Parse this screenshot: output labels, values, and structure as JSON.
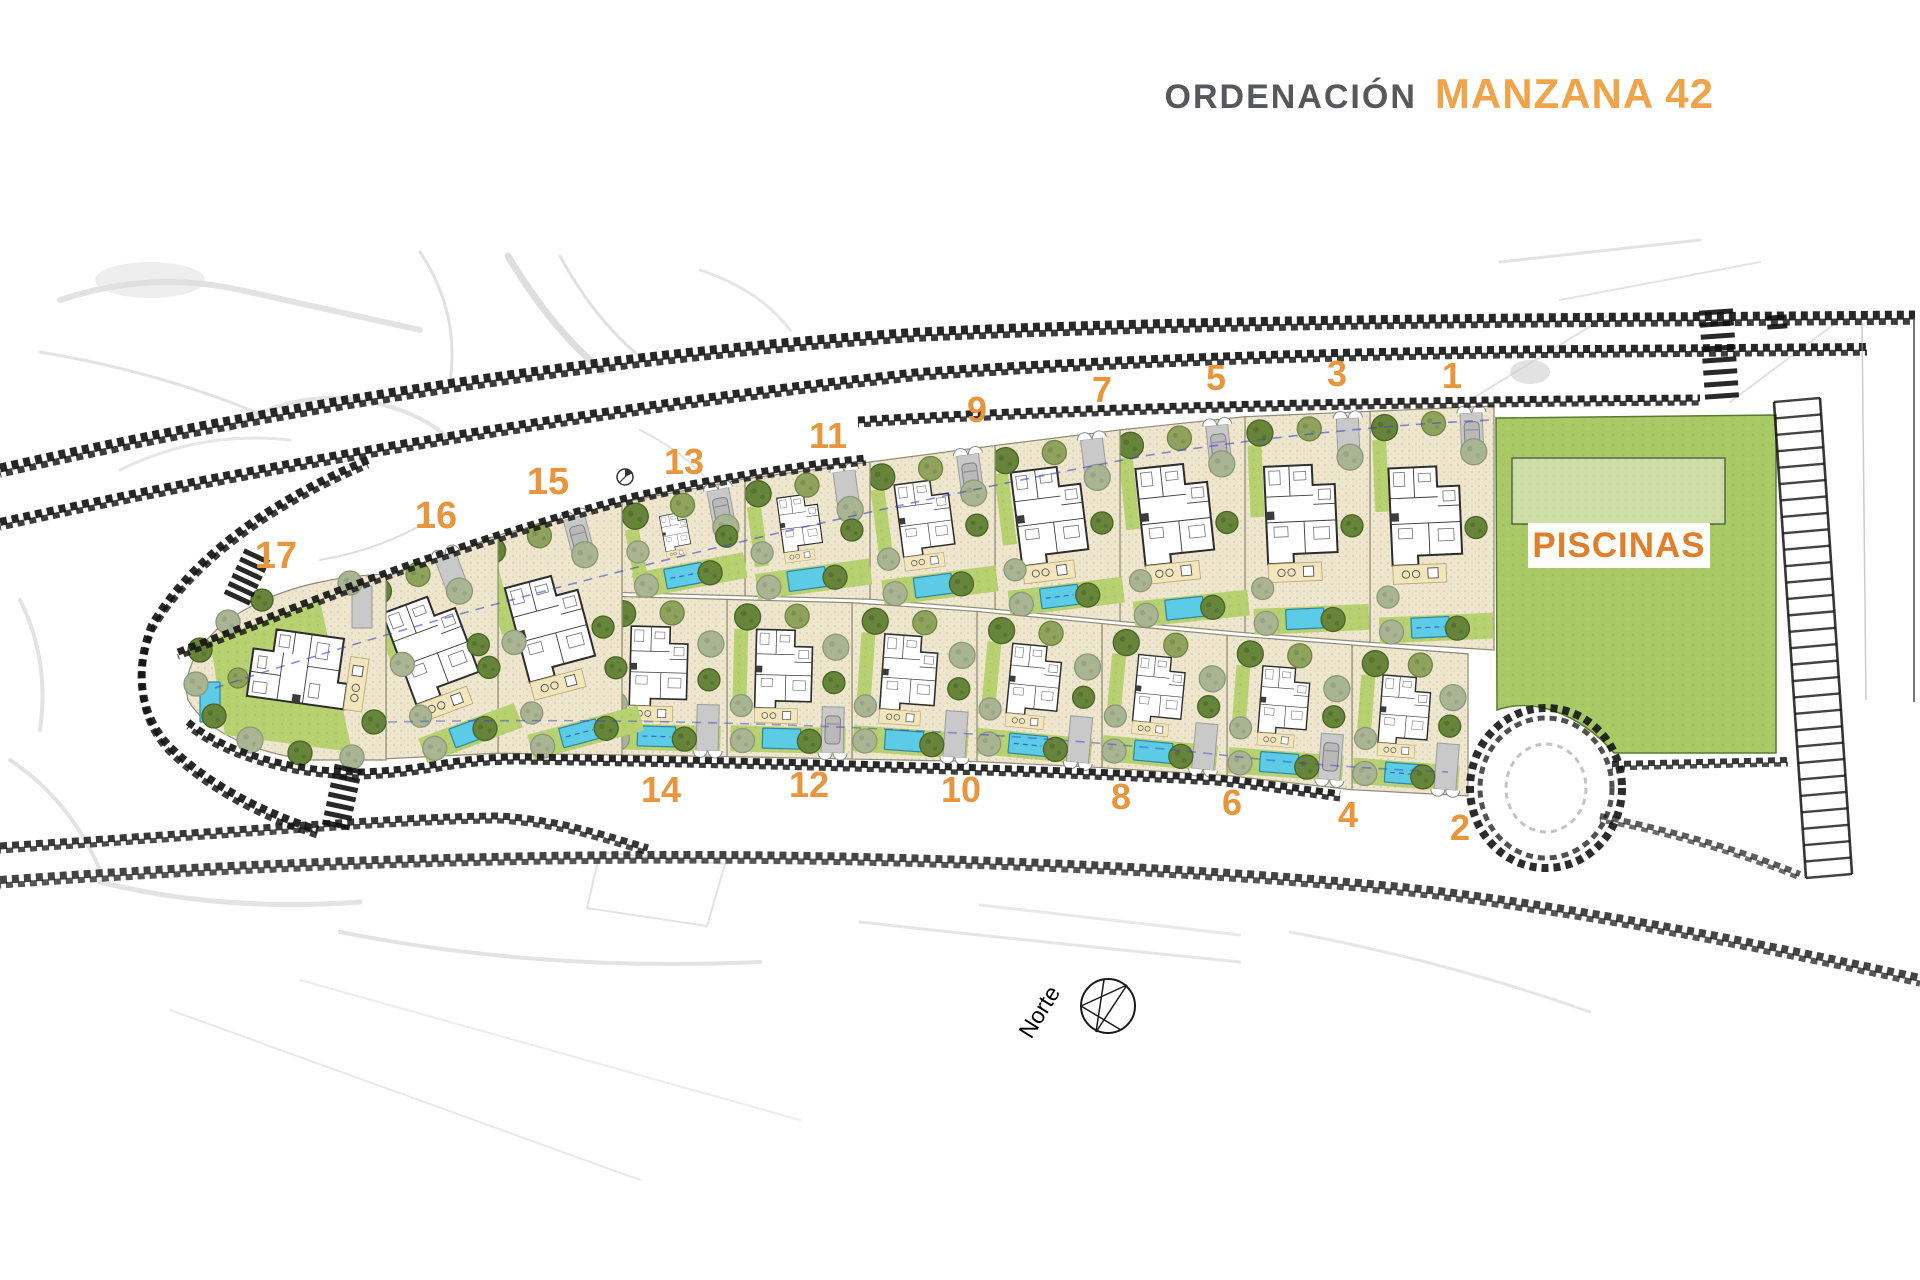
{
  "header": {
    "section_label": "ORDENACIÓN",
    "block_label": "MANZANA 42"
  },
  "plan": {
    "pool_area_label": "PISCINAS",
    "north_label": "Norte",
    "top_plot_labels": [
      {
        "n": "1",
        "x": 1452,
        "y": 388
      },
      {
        "n": "3",
        "x": 1337,
        "y": 386
      },
      {
        "n": "5",
        "x": 1216,
        "y": 390
      },
      {
        "n": "7",
        "x": 1102,
        "y": 402
      },
      {
        "n": "9",
        "x": 977,
        "y": 422
      },
      {
        "n": "11",
        "x": 828,
        "y": 448
      },
      {
        "n": "13",
        "x": 684,
        "y": 474
      },
      {
        "n": "15",
        "x": 548,
        "y": 494
      },
      {
        "n": "16",
        "x": 436,
        "y": 528
      },
      {
        "n": "17",
        "x": 276,
        "y": 568
      }
    ],
    "bottom_plot_labels": [
      {
        "n": "2",
        "x": 1460,
        "y": 840
      },
      {
        "n": "4",
        "x": 1348,
        "y": 827
      },
      {
        "n": "6",
        "x": 1232,
        "y": 815
      },
      {
        "n": "8",
        "x": 1121,
        "y": 809
      },
      {
        "n": "10",
        "x": 961,
        "y": 802
      },
      {
        "n": "12",
        "x": 809,
        "y": 797
      },
      {
        "n": "14",
        "x": 661,
        "y": 802
      }
    ]
  },
  "colors": {
    "accent_orange": "#E8953C",
    "piscinas_orange": "#DF7E2B",
    "title_gray": "#57585C",
    "title_orange": "#F0A44A",
    "pool_blue": "#5BCBE6",
    "pool_blue_edge": "#2E86A3",
    "grass_green": "#B7D170",
    "park_green": "#A9C966",
    "park_light": "#C9DBA0",
    "sand": "#EEE6CE",
    "villa_wall": "#2D2D2D",
    "road_black": "#151515",
    "tree_olive": "#66853A",
    "tree_olive_edge": "#4A6326",
    "tree_sage": "#A9B492",
    "tree_sage_edge": "#8C987B",
    "tree_pale": "#8FA35E",
    "tree_pale_edge": "#6F8440",
    "driveway_gray": "#C9C9C9",
    "terrace_beige": "#F3E5BC"
  }
}
